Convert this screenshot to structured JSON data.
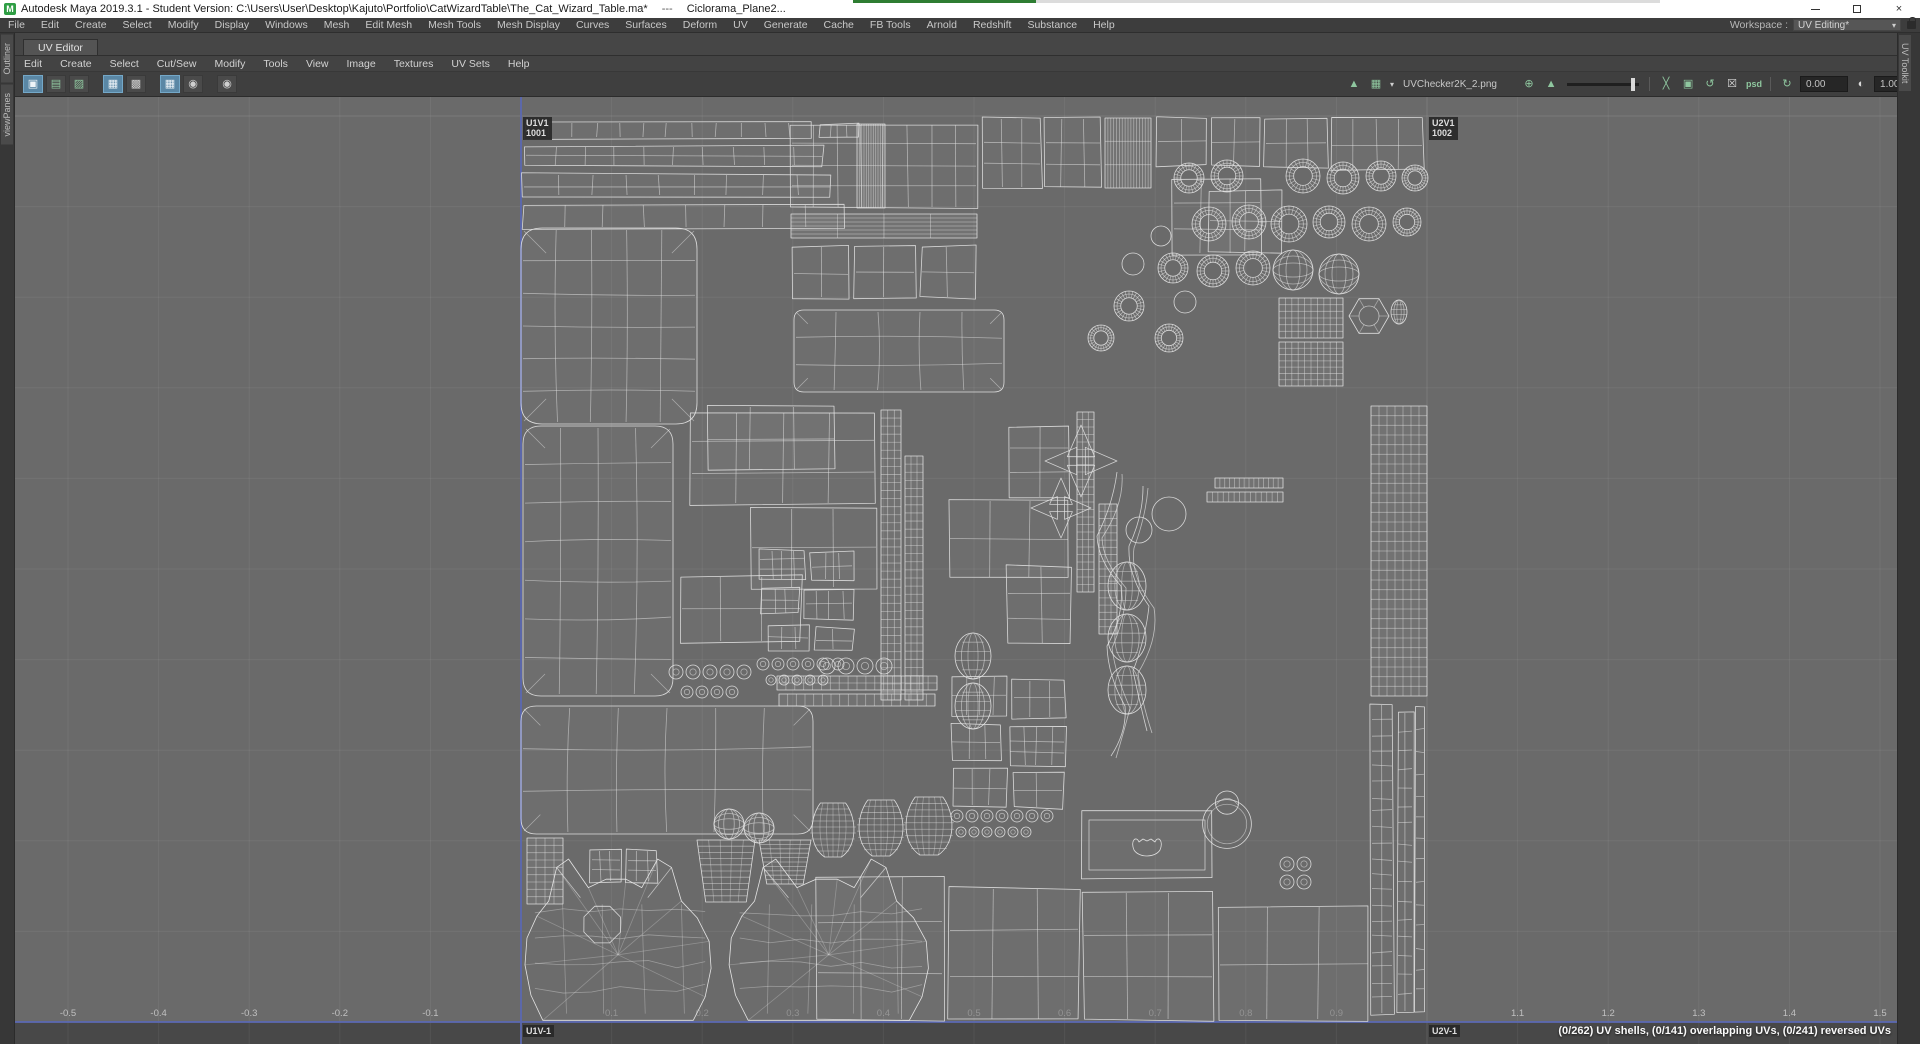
{
  "title_bar": {
    "app_title": "Autodesk Maya 2019.3.1 - Student Version: C:\\Users\\User\\Desktop\\Kajuto\\Portfolio\\CatWizardTable\\The_Cat_Wizard_Table.ma*",
    "separator": "---",
    "scene_suffix": "Ciclorama_Plane2...",
    "logo_letter": "M",
    "close_glyph": "×"
  },
  "main_menu": {
    "items": [
      "File",
      "Edit",
      "Create",
      "Select",
      "Modify",
      "Display",
      "Windows",
      "Mesh",
      "Edit Mesh",
      "Mesh Tools",
      "Mesh Display",
      "Curves",
      "Surfaces",
      "Deform",
      "UV",
      "Generate",
      "Cache",
      "FB Tools",
      "Arnold",
      "Redshift",
      "Substance",
      "Help"
    ]
  },
  "workspace": {
    "label": "Workspace :",
    "value": "UV Editing*",
    "arrow": "▾"
  },
  "uv_editor": {
    "tab_label": "UV Editor",
    "menu_items": [
      "Edit",
      "Create",
      "Select",
      "Cut/Sew",
      "Modify",
      "Tools",
      "View",
      "Image",
      "Textures",
      "UV Sets",
      "Help"
    ],
    "left_icons": [
      {
        "name": "uv-shell-select-icon",
        "glyph": "▣",
        "style": "active"
      },
      {
        "name": "copy-uvs-icon",
        "glyph": "▤",
        "style": "green"
      },
      {
        "name": "paste-uvs-icon",
        "glyph": "▨",
        "style": "green"
      },
      {
        "name": "texture-borders-icon",
        "glyph": "▦",
        "style": "active"
      },
      {
        "name": "shaded-uv-display-icon",
        "glyph": "▩",
        "style": "plain"
      },
      {
        "name": "checker-tiles-icon",
        "glyph": "▦",
        "style": "active"
      },
      {
        "name": "dim-image-icon",
        "glyph": "◉",
        "style": "plain"
      },
      {
        "name": "uv-snapshot-icon",
        "glyph": "◉",
        "style": "plain"
      }
    ],
    "toolbar": {
      "texture_file": "UVChecker2K_2.png",
      "exposure_value": "0.00",
      "gamma_value": "1.00",
      "color_transform": "sRGB gamma",
      "icons": {
        "image_display": {
          "glyph": "▲"
        },
        "checker_map": {
          "glyph": "▦"
        },
        "dropdown_arrow": {
          "glyph": "▾"
        },
        "shader_ball": {
          "glyph": "⊕"
        },
        "image_ratio": {
          "glyph": "▲"
        },
        "expand_image": {
          "glyph": "╳"
        },
        "frame_image": {
          "glyph": "▣"
        },
        "reload_image": {
          "glyph": "↺"
        },
        "pixel_snap": {
          "glyph": "☒"
        },
        "psd": {
          "glyph": "psd"
        },
        "refresh": {
          "glyph": "↻"
        },
        "contrast": {
          "glyph": "◐"
        },
        "color_managed": {
          "glyph": "◉"
        }
      }
    }
  },
  "side_panels": {
    "left_tabs": [
      "Outliner",
      "viewPanes"
    ],
    "right_tabs": [
      "UV Toolkit"
    ]
  },
  "uv_canvas": {
    "tile_labels": [
      {
        "grid": "U1V1",
        "udim": "1001"
      },
      {
        "grid": "U2V1",
        "udim": "1002"
      },
      {
        "grid": "U1V-1",
        "udim": ""
      },
      {
        "grid": "U2V-1",
        "udim": ""
      }
    ],
    "u_axis_labels": [
      "-0.5",
      "-0.4",
      "-0.3",
      "-0.2",
      "-0.1",
      "0.1",
      "0.2",
      "0.3",
      "0.4",
      "0.5",
      "0.6",
      "0.7",
      "0.8",
      "0.9",
      "1.1",
      "1.2",
      "1.3",
      "1.4",
      "1.5"
    ],
    "status_text": "(0/262) UV shells, (0/141) overlapping UVs, (0/241) reversed UVs"
  },
  "colors": {
    "axis_blue": "#5a68b0",
    "wireframe": "#e4e4e4",
    "canvas_bg": "#6a6a6a",
    "active_blue": "#5a87a5",
    "icon_green": "#8fc79f",
    "progress_green": "#2e7d32"
  }
}
